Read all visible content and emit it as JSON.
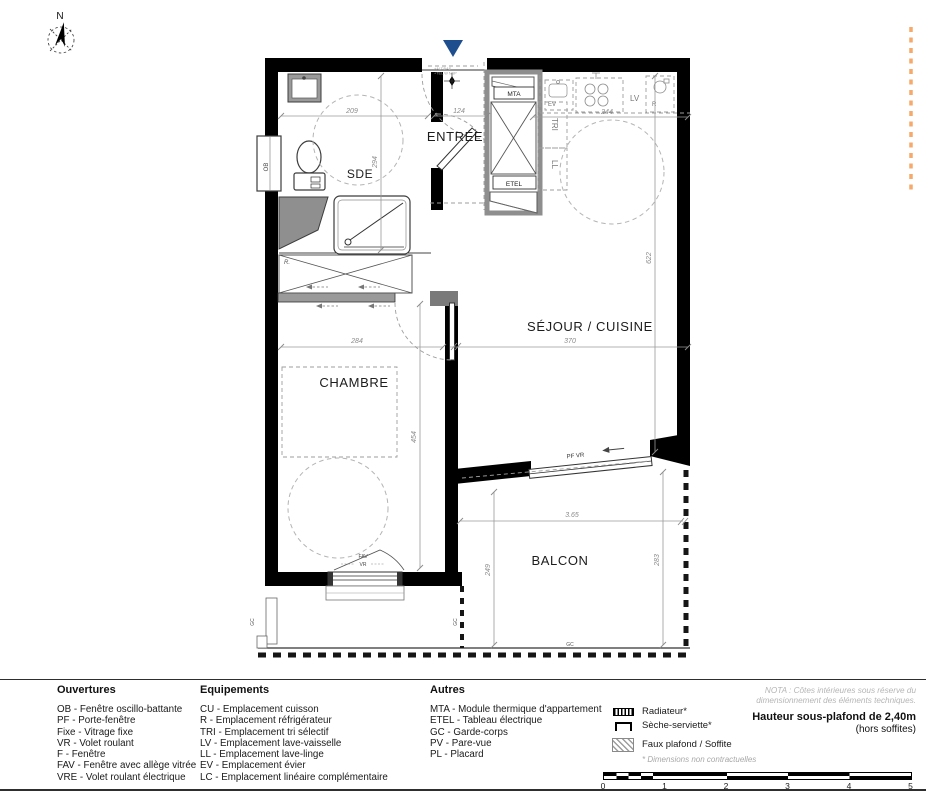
{
  "plan": {
    "compass_label": "N",
    "rooms": {
      "sde": "SDE",
      "entree": "ENTRÉE",
      "sejour": "SÉJOUR / CUISINE",
      "chambre": "CHAMBRE",
      "balcon": "BALCON"
    },
    "labels": {
      "mta": "MTA",
      "etel": "ETEL",
      "tri": "TRI",
      "ll": "LL",
      "lv": "LV",
      "ev": "EV",
      "r": "R",
      "closet": "R.",
      "ob": "OB",
      "fav": "FAV",
      "vr": "VR",
      "pf_vr": "PF VR",
      "gc": "GC",
      "entry_note1": "+ALT.BAS",
      "entry_note2": "+TEL.W NSP"
    },
    "dims": {
      "d209": "209",
      "d124": "124",
      "d244": "244",
      "d294": "294",
      "d622": "622",
      "d284": "284",
      "d370": "370",
      "d454": "454",
      "d365": "3.65",
      "d249": "249",
      "d283": "283"
    }
  },
  "legend": {
    "ouvertures": {
      "title": "Ouvertures",
      "items": [
        "OB - Fenêtre oscillo-battante",
        "PF - Porte-fenêtre",
        "Fixe - Vitrage fixe",
        "VR - Volet roulant",
        "F - Fenêtre",
        "FAV - Fenêtre avec allège vitrée",
        "VRE - Volet roulant électrique"
      ]
    },
    "equipements": {
      "title": "Equipements",
      "items": [
        "CU - Emplacement cuisson",
        "R - Emplacement réfrigérateur",
        "TRI - Emplacement tri sélectif",
        "LV - Emplacement lave-vaisselle",
        "LL - Emplacement lave-linge",
        "EV - Emplacement évier",
        "LC - Emplacement linéaire complémentaire"
      ]
    },
    "autres": {
      "title": "Autres",
      "items": [
        "MTA - Module thermique d'appartement",
        "ETEL - Tableau électrique",
        "GC - Garde-corps",
        "PV - Pare-vue",
        "PL - Placard"
      ]
    },
    "symbols": {
      "radiateur": "Radiateur*",
      "seche_serviette": "Sèche-serviette*",
      "faux_plafond": "Faux plafond / Soffite",
      "footnote": "* Dimensions non contractuelles"
    },
    "nota_line1": "NOTA : Côtes intérieures sous réserve du",
    "nota_line2": "dimensionnement des éléments techniques.",
    "ceiling": "Hauteur sous-plafond de 2,40m",
    "ceiling_sub": "(hors soffites)",
    "scale_ticks": [
      "0",
      "1",
      "2",
      "3",
      "4",
      "5"
    ]
  },
  "colors": {
    "wall": "#000000",
    "entry_arrow_blue": "#1f4e8f",
    "orange_dash": "#f6a96b",
    "dim_gray": "#8a8a8a"
  }
}
